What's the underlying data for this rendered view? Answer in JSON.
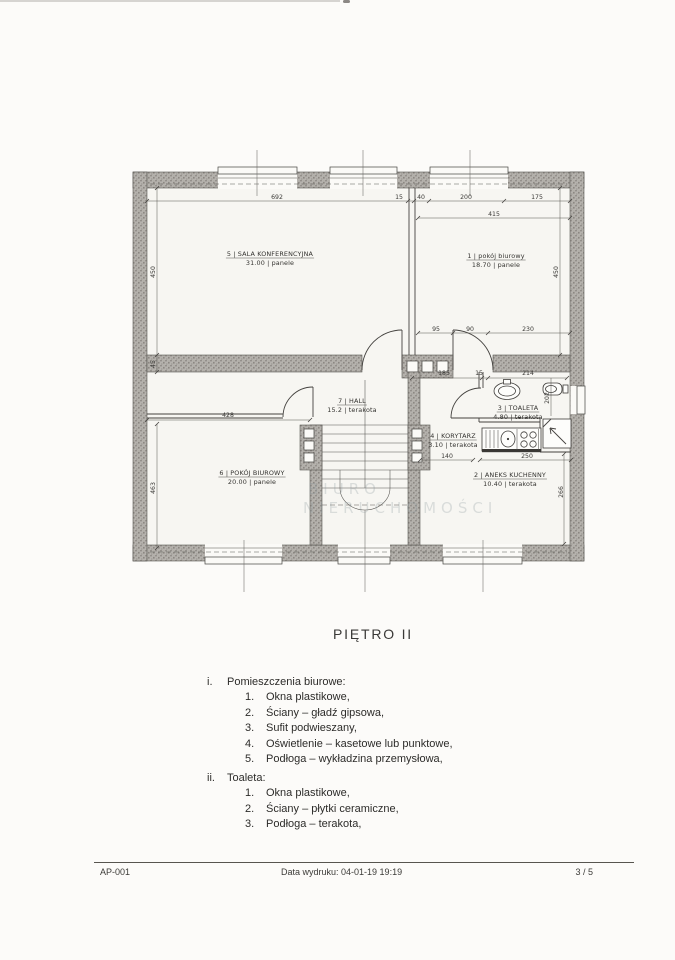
{
  "page": {
    "title": "PIĘTRO  II",
    "footer": {
      "left": "AP-001",
      "center": "Data wydruku: 04-01-19 19:19",
      "right": "3 / 5"
    }
  },
  "specs": {
    "sections": [
      {
        "marker": "i.",
        "heading": "Pomieszczenia biurowe:",
        "items": [
          "Okna plastikowe,",
          "Ściany – gładź gipsowa,",
          "Sufit podwieszany,",
          "Oświetlenie – kasetowe lub punktowe,",
          "Podłoga – wykładzina przemysłowa,"
        ]
      },
      {
        "marker": "ii.",
        "heading": "Toaleta:",
        "items": [
          "Okna plastikowe,",
          "Ściany – płytki ceramiczne,",
          "Podłoga – terakota,"
        ]
      }
    ]
  },
  "plan": {
    "watermark": [
      "BIURO",
      "NIERUCHOMOŚCI"
    ],
    "rooms": [
      {
        "num": "5",
        "name": "SALA KONFERENCYJNA",
        "area": "31.00",
        "floor": "panele",
        "x": 270,
        "y": 256
      },
      {
        "num": "1",
        "name": "pokój biurowy",
        "area": "18.70",
        "floor": "panele",
        "x": 496,
        "y": 258
      },
      {
        "num": "7",
        "name": "HALL",
        "area": "15.2",
        "floor": "terakota",
        "x": 352,
        "y": 403
      },
      {
        "num": "4",
        "name": "KORYTARZ",
        "area": "3.10",
        "floor": "terakota",
        "x": 453,
        "y": 438
      },
      {
        "num": "3",
        "name": "TOALETA",
        "area": "4.80",
        "floor": "terakota",
        "x": 518,
        "y": 410
      },
      {
        "num": "2",
        "name": "ANEKS KUCHENNY",
        "area": "10.40",
        "floor": "terakota",
        "x": 510,
        "y": 477
      },
      {
        "num": "6",
        "name": "POKÓJ BIUROWY",
        "area": "20.00",
        "floor": "panele",
        "x": 252,
        "y": 475
      }
    ],
    "dimensions": [
      {
        "v": "692",
        "x": 277,
        "y": 199
      },
      {
        "v": "15",
        "x": 399,
        "y": 199
      },
      {
        "v": "40",
        "x": 421,
        "y": 199
      },
      {
        "v": "200",
        "x": 466,
        "y": 199
      },
      {
        "v": "175",
        "x": 537,
        "y": 199
      },
      {
        "v": "415",
        "x": 494,
        "y": 216
      },
      {
        "v": "450",
        "x": 155,
        "y": 272,
        "r": -90
      },
      {
        "v": "45",
        "x": 155,
        "y": 364,
        "r": -90
      },
      {
        "v": "450",
        "x": 558,
        "y": 272,
        "r": -90
      },
      {
        "v": "95",
        "x": 436,
        "y": 331
      },
      {
        "v": "90",
        "x": 470,
        "y": 331
      },
      {
        "v": "230",
        "x": 528,
        "y": 331
      },
      {
        "v": "185",
        "x": 444,
        "y": 375
      },
      {
        "v": "15",
        "x": 479,
        "y": 375
      },
      {
        "v": "214",
        "x": 528,
        "y": 375
      },
      {
        "v": "202",
        "x": 549,
        "y": 398,
        "r": -90
      },
      {
        "v": "428",
        "x": 228,
        "y": 417
      },
      {
        "v": "463",
        "x": 155,
        "y": 488,
        "r": -90
      },
      {
        "v": "140",
        "x": 447,
        "y": 458
      },
      {
        "v": "250",
        "x": 527,
        "y": 458
      },
      {
        "v": "266",
        "x": 563,
        "y": 492,
        "r": -90
      }
    ]
  }
}
